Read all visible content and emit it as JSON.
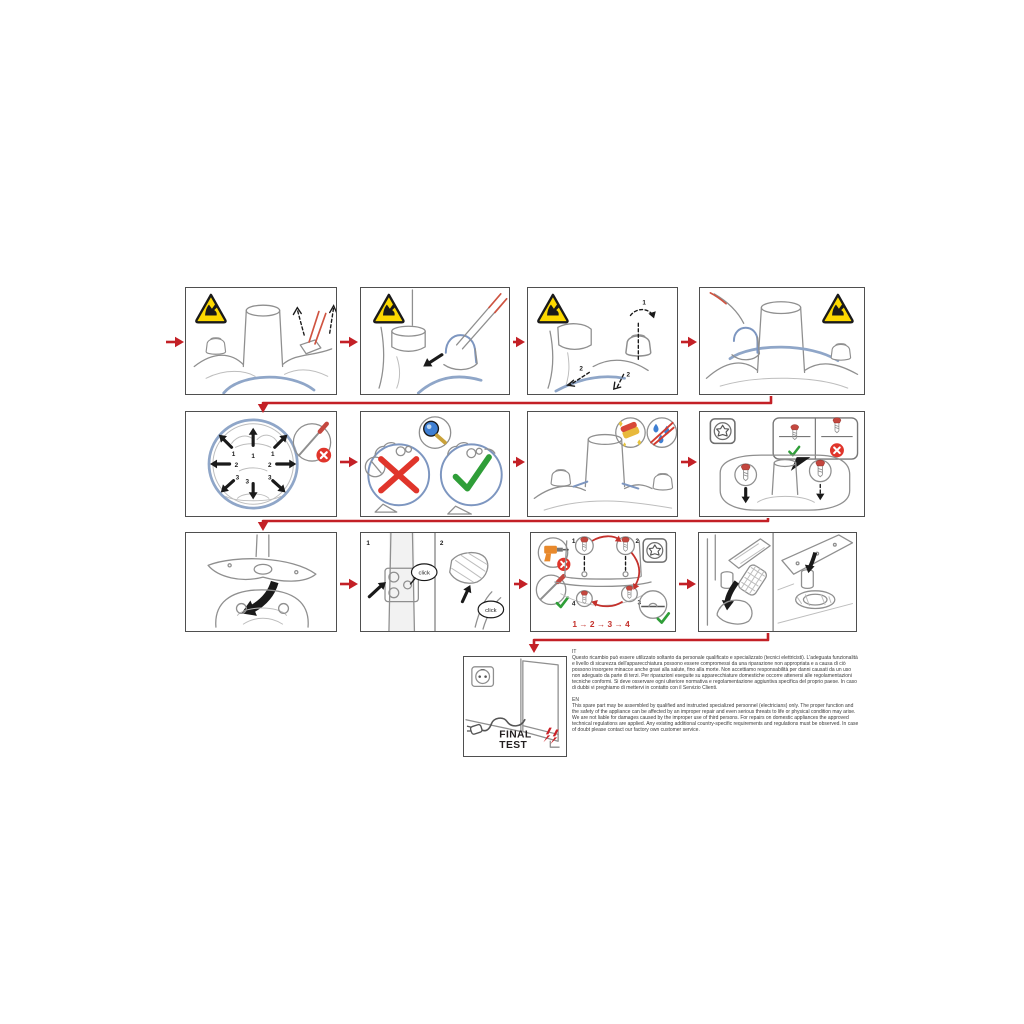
{
  "colors": {
    "flow_red": "#c32026",
    "warning_yellow": "#fcd800",
    "check_green": "#2f9e38",
    "error_red": "#e0352b",
    "line_gray": "#8f8f8f",
    "accent_blue": "#8fa6c8",
    "text_black": "#231f20"
  },
  "icons": [
    "warning-sharp-edges-icon",
    "no-screwdriver-pry-icon",
    "inspect-magnifier-icon",
    "ok-check-icon",
    "not-allowed-x-icon",
    "sponge-clean-icon",
    "no-water-icon",
    "torx-screw-icon",
    "screw-icon",
    "no-power-drill-icon",
    "hand-screwdriver-ok-icon",
    "flush-seat-ok-icon",
    "click-bubble",
    "power-socket-icon",
    "power-plug-icon",
    "lightning-bolts-icon"
  ],
  "steps": {
    "row1_panel3_labels": [
      "1",
      "2",
      "2"
    ],
    "row2_panel1_labels": [
      "1",
      "1",
      "1",
      "2",
      "2",
      "3",
      "3",
      "3"
    ],
    "row3_panel2": {
      "cells": [
        "1",
        "2"
      ],
      "click": "click"
    },
    "row3_panel3": {
      "screws": [
        "1",
        "2",
        "3",
        "4"
      ],
      "sequence": "1 → 2 → 3 → 4"
    }
  },
  "final_test": {
    "word1": "FINAL",
    "word2": "TEST"
  },
  "legal": {
    "it": {
      "header": "IT",
      "body": "Questo ricambio può essere utilizzato soltanto da personale qualificato e specializzato (tecnici elettricisti). L'adeguata funzionalità e livello di sicurezza dell'apparecchiatura possono essere compromessi da una riparazione non appropriata e a causa di ciò possono insorgere minacce anche gravi alla salute, fino alla morte. Non accettiamo responsabilità per danni causati da un uso non adeguato da parte di terzi. Per riparazioni eseguite su apparecchiature domestiche occorre attenersi alle regolamentazioni tecniche conformi. Si deve osservare ogni ulteriore normativa e regolamentazione aggiuntiva specifica del proprio paese. In caso di dubbi vi preghiamo di mettervi in contatto con il Servizio Clienti."
    },
    "en": {
      "header": "EN",
      "body": "This spare part may be assembled by qualified and instructed specialized personnel (electricians) only. The proper function and the safety of the appliance can be affected by an improper repair and even serious threats to life or physical condition may arise. We are not liable for damages caused by the improper use of third persons. For repairs on domestic appliances the approved technical regulations are applied. Any existing additional country-specific requirements and regulations must be observed. In case of doubt please contact our factory own customer service."
    }
  }
}
